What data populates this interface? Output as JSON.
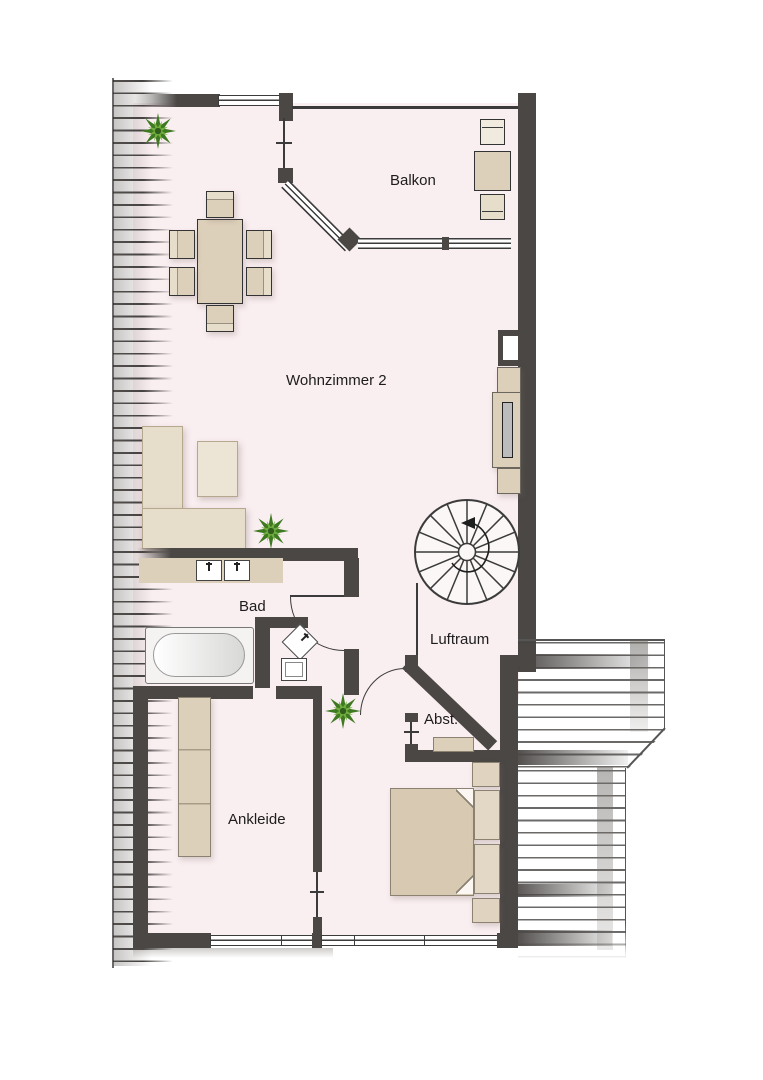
{
  "floorplan": {
    "type": "attic floor plan",
    "labels": {
      "balkon": "Balkon",
      "wohnzimmer": "Wohnzimmer 2",
      "bad": "Bad",
      "luftraum": "Luftraum",
      "abstellraum": "Abst.",
      "ankleide": "Ankleide"
    },
    "colors": {
      "wall": "#4a4745",
      "floor": "#f9eef0",
      "line": "#3b3b3b",
      "furniture": "#ddd0ba",
      "furniture-light": "#e7ddcb",
      "plant-dark": "#4e8c2c",
      "plant-light": "#72ae3e"
    }
  }
}
